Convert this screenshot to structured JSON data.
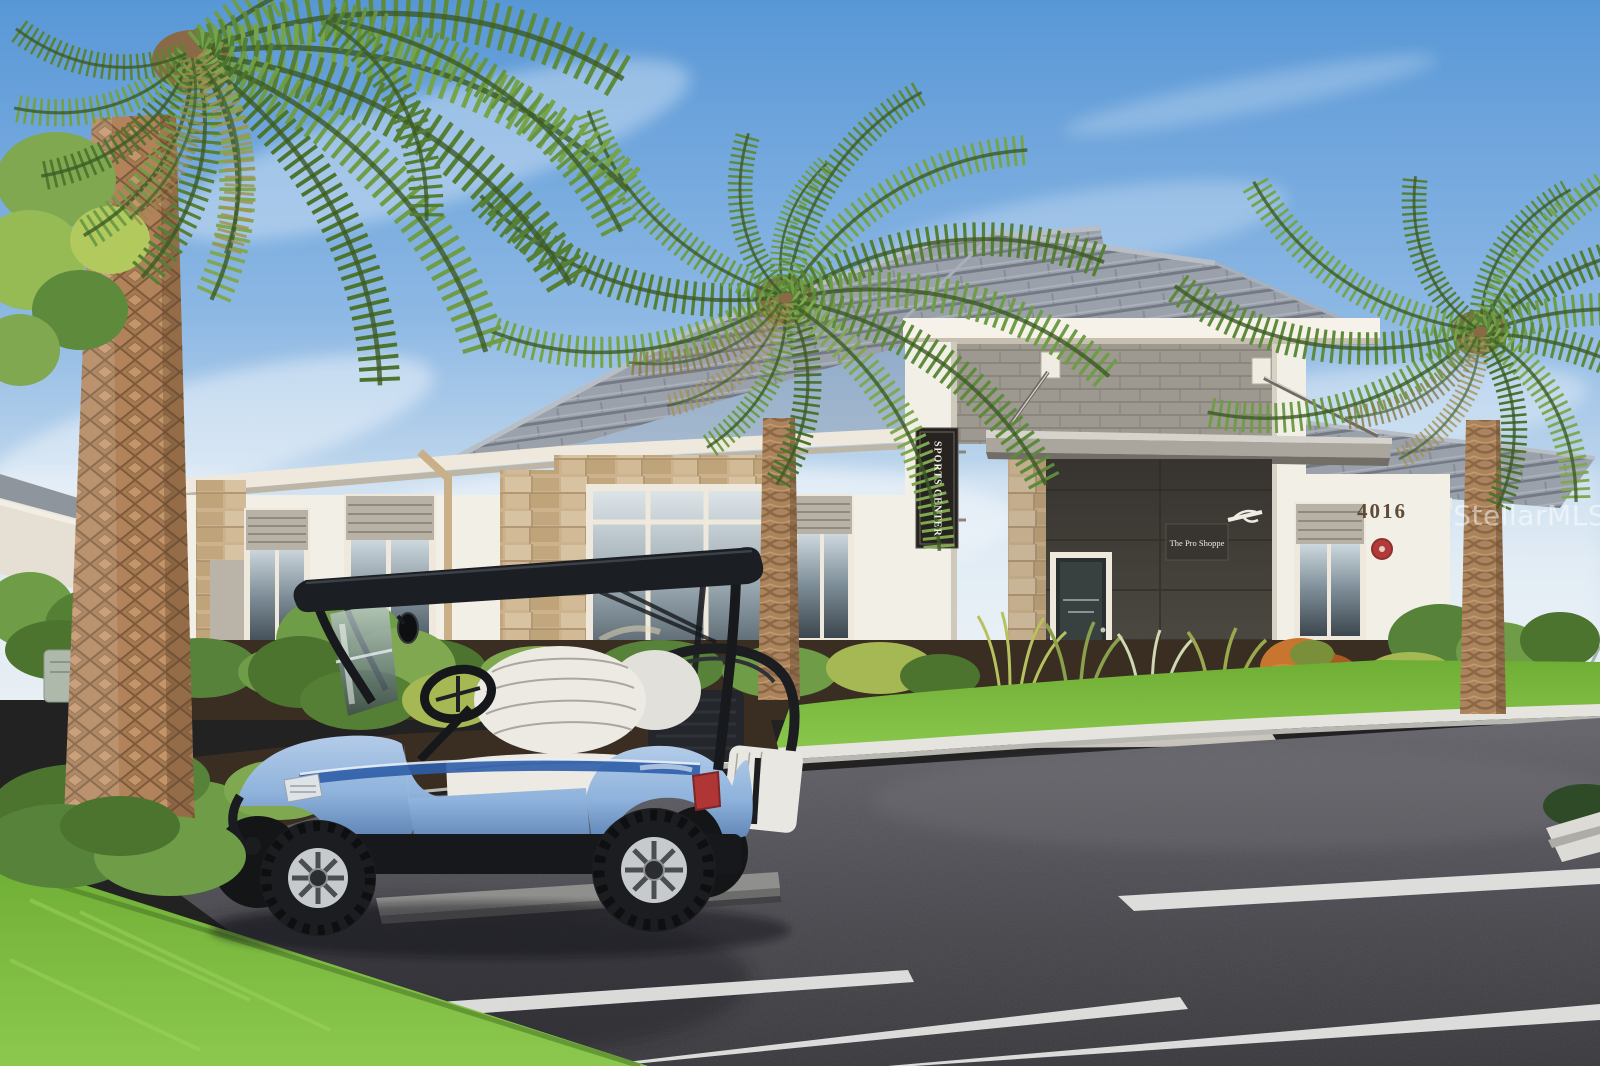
{
  "photo": {
    "signs": {
      "blade": "SPORTS CENTER",
      "hanging": "The Pro Shoppe",
      "address": "4016"
    },
    "watermark": "StellarMLS",
    "colors": {
      "sky_top": "#5897d6",
      "sky_horizon": "#e8eff5",
      "roof_tile": "#9ba1aa",
      "stucco": "#f4f1e8",
      "stone_veneer": "#cdb38d",
      "cmu_block": "#9d9890",
      "asphalt": "#4e4d52",
      "parking_stripe": "#e9e9e7",
      "lawn": "#79b244",
      "mulch": "#3a2d22",
      "cart_blue": "#8fb3dc",
      "cart_swoosh": "#2f5ea8",
      "cart_roof": "#1b1e22",
      "seat_white": "#eceae3",
      "sign_background": "#262220",
      "badge_red": "#b23a3a",
      "palm_frond": "#6f9c46",
      "palm_trunk": "#b2835a"
    }
  }
}
